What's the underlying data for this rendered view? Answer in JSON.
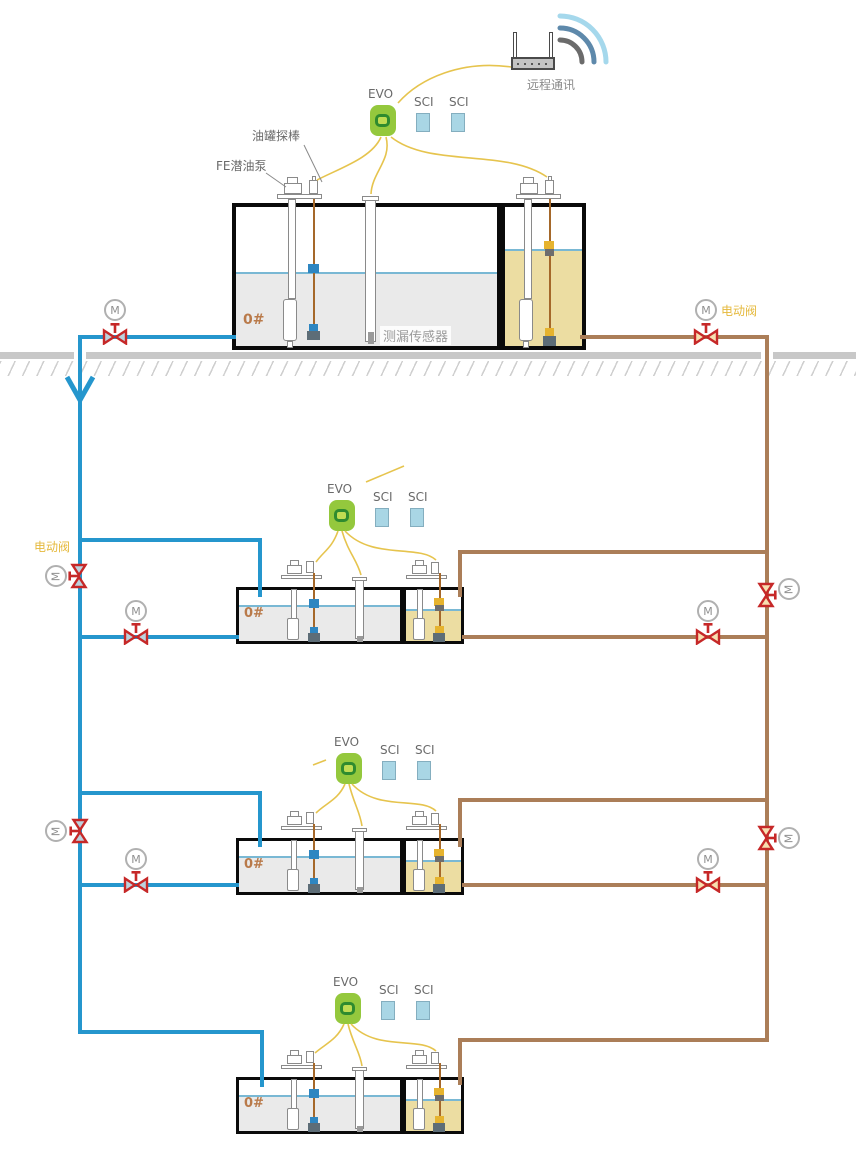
{
  "labels": {
    "remote_comm": "远程通讯",
    "electric_valve": "电动阀",
    "motor": "M",
    "tank_probe": "油罐探棒",
    "submersible_pump": "FE潜油泵",
    "leak_sensor": "测漏传感器"
  },
  "stations": [
    {
      "controller": "EVO",
      "modules": [
        "SCI",
        "SCI"
      ],
      "fuel_grade": "0#"
    },
    {
      "controller": "EVO",
      "modules": [
        "SCI",
        "SCI"
      ],
      "fuel_grade": "0#"
    },
    {
      "controller": "EVO",
      "modules": [
        "SCI",
        "SCI"
      ],
      "fuel_grade": "0#"
    },
    {
      "controller": "EVO",
      "modules": [
        "SCI",
        "SCI"
      ],
      "fuel_grade": "0#"
    }
  ],
  "colors": {
    "pipe_blue": "#2596cd",
    "pipe_brown": "#ab7e58",
    "wire_yellow": "#e6c44e",
    "valve_red": "#c62828",
    "evo_green": "#94c83d",
    "sci_blue": "#a9d6e5",
    "diesel_liquid": "#eaeaea",
    "gasoline_liquid": "#ecdda2",
    "ground_gray": "#c8c8c8"
  }
}
